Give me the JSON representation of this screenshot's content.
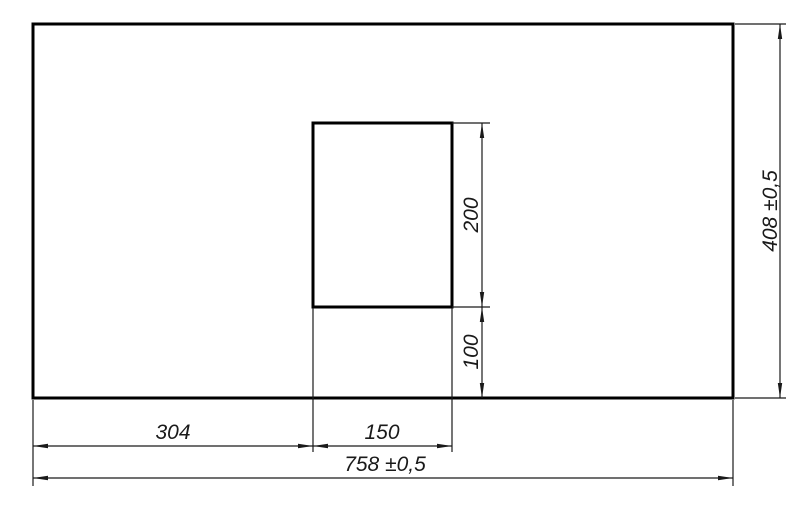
{
  "drawing": {
    "labels": {
      "offset_left": "304",
      "cutout_width": "150",
      "total_width": "758 ±0,5",
      "cutout_height": "200",
      "offset_bottom": "100",
      "total_height": "408 ±0,5"
    },
    "colors": {
      "line": "#000000",
      "text": "#1a1a1a",
      "background": "#ffffff"
    }
  }
}
